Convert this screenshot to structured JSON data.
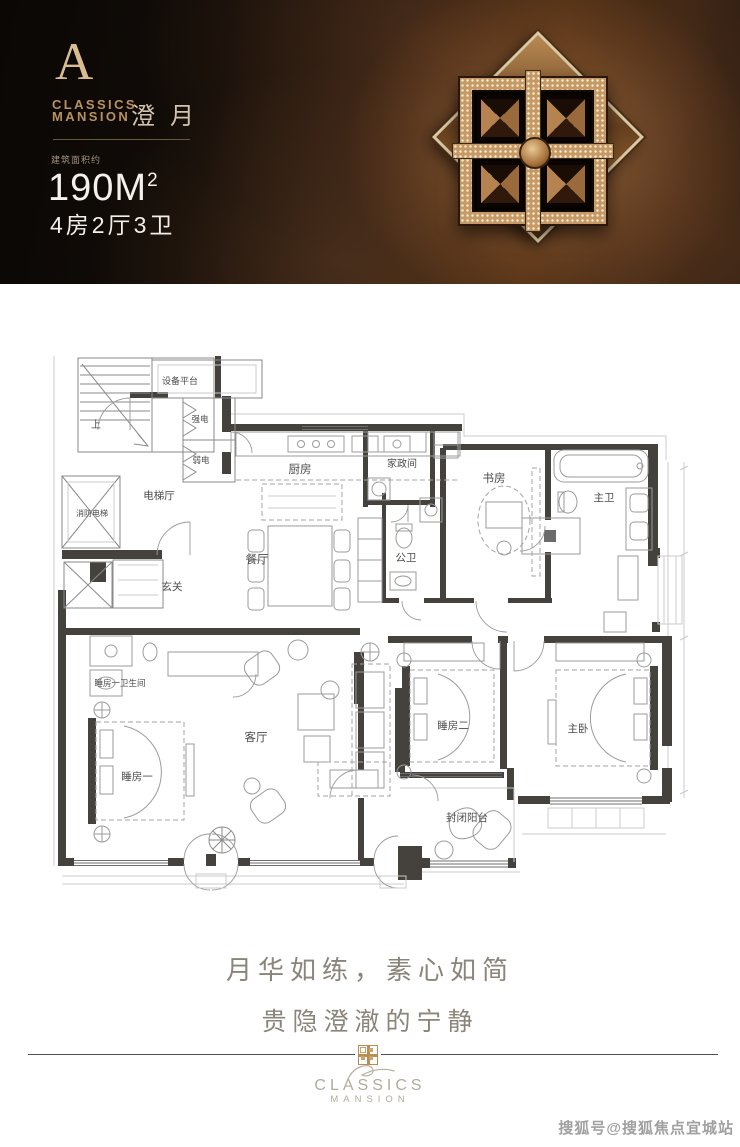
{
  "header": {
    "unit_letter": "A",
    "brand_en_line1": "CLASSICS",
    "brand_en_line2": "MANSION",
    "unit_name_cn": "澄月",
    "area_label": "建筑面积约",
    "area_value": "190M",
    "area_superscript": "2",
    "layout_text": "4房2厅3卫"
  },
  "floor_plan": {
    "rooms": [
      {
        "label": "设备平台"
      },
      {
        "label": "上"
      },
      {
        "label": "强电"
      },
      {
        "label": "弱电"
      },
      {
        "label": "消防电梯"
      },
      {
        "label": "电梯厅"
      },
      {
        "label": "厨房"
      },
      {
        "label": "家政间"
      },
      {
        "label": "书房"
      },
      {
        "label": "主卫"
      },
      {
        "label": "餐厅"
      },
      {
        "label": "公卫"
      },
      {
        "label": "玄关"
      },
      {
        "label": "睡房一卫生间"
      },
      {
        "label": "客厅"
      },
      {
        "label": "睡房一"
      },
      {
        "label": "睡房二"
      },
      {
        "label": "主卧"
      },
      {
        "label": "封闭阳台"
      }
    ]
  },
  "tagline": {
    "line1": "月华如练，素心如简",
    "line2": "贵隐澄澈的宁静"
  },
  "footer": {
    "brand_en_line1": "CLASSICS",
    "brand_en_line2": "MANSION"
  },
  "watermark": {
    "text": "搜狐号@搜狐焦点宜城站"
  },
  "colors": {
    "gold": "#c8a273",
    "header_bg": "#17100b",
    "tagline_gray": "#8b847a",
    "wall": "#45423e"
  }
}
